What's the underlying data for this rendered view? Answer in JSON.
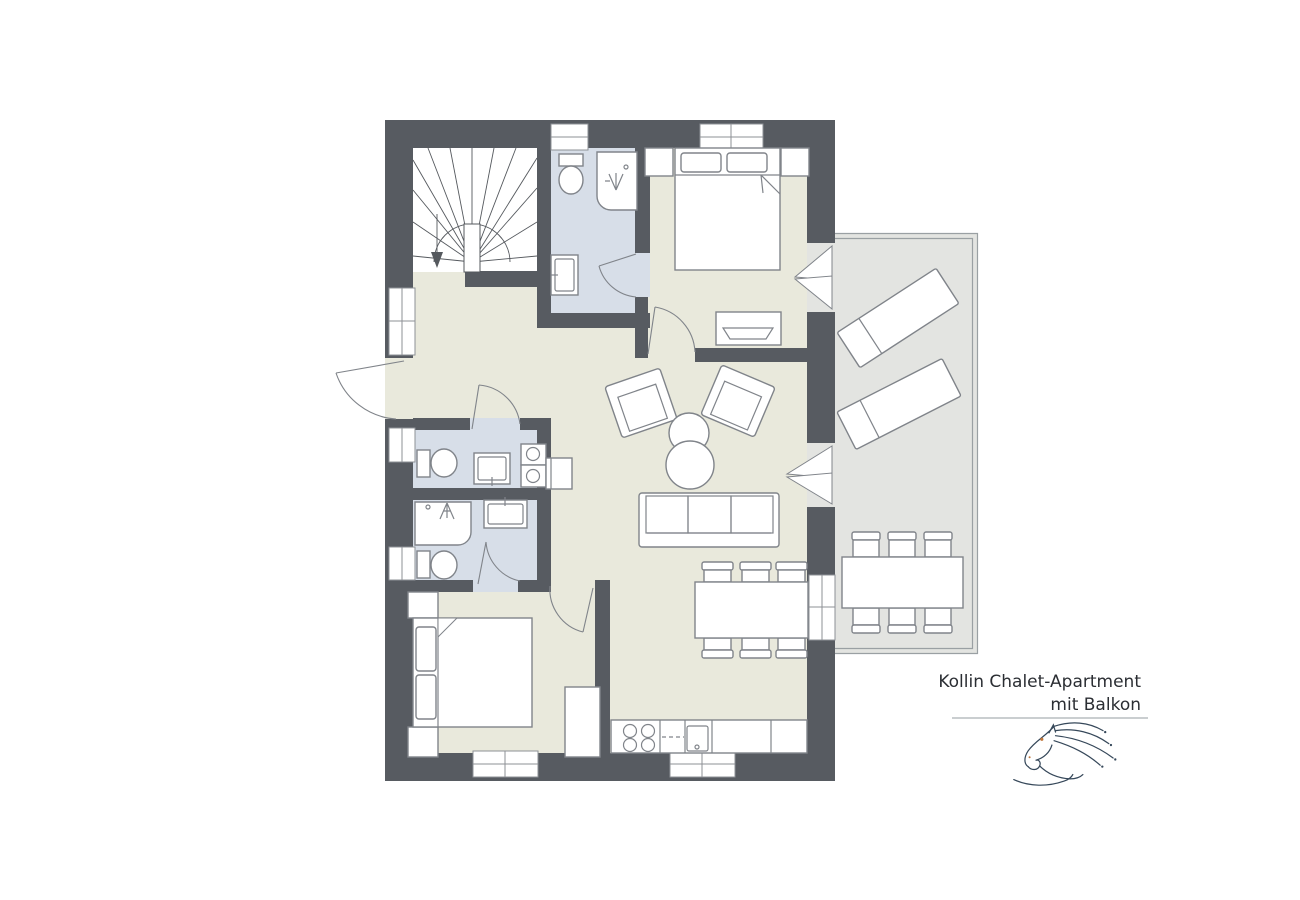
{
  "title": {
    "line1": "Kollin Chalet-Apartment",
    "line2": "mit Balkon"
  },
  "palette": {
    "background": "#ffffff",
    "wall": "#575b61",
    "floor": "#e9e9dc",
    "bathroom_floor": "#d7dee8",
    "balcony_floor": "#e3e4e1",
    "furniture_outline": "#80848a",
    "stair_line": "#55595e",
    "window_frame": "#8d9196",
    "logo_line": "#36485a",
    "logo_accent": "#c0763a",
    "title_text": "#2b2e33",
    "divider": "#b9bdc0"
  },
  "semantics": {
    "rooms": [
      "staircase",
      "upper-bathroom",
      "upper-bedroom",
      "hallway",
      "wc-laundry",
      "shower-bathroom",
      "lower-bedroom",
      "living-room",
      "dining-area",
      "kitchen",
      "balcony"
    ],
    "fixtures": [
      "winder-stairs",
      "toilet",
      "shower",
      "washbasin",
      "washer",
      "dryer",
      "double-bed",
      "nightstand",
      "bench",
      "wardrobe",
      "armchair",
      "round-coffee-tables",
      "three-seat-sofa",
      "dining-table-six-chairs",
      "kitchen-counter",
      "stove-four-burners",
      "kitchen-sink",
      "dishwasher-dashes",
      "sun-lounger",
      "outdoor-dining-table-six-chairs"
    ],
    "doors": [
      "entrance-door",
      "wc-door",
      "shower-bathroom-door",
      "upper-bathroom-door",
      "upper-bedroom-door",
      "lower-bedroom-door",
      "french-balcony-door-bedroom",
      "french-balcony-door-living"
    ],
    "windows_count": 8,
    "logo": "horse-logo"
  }
}
